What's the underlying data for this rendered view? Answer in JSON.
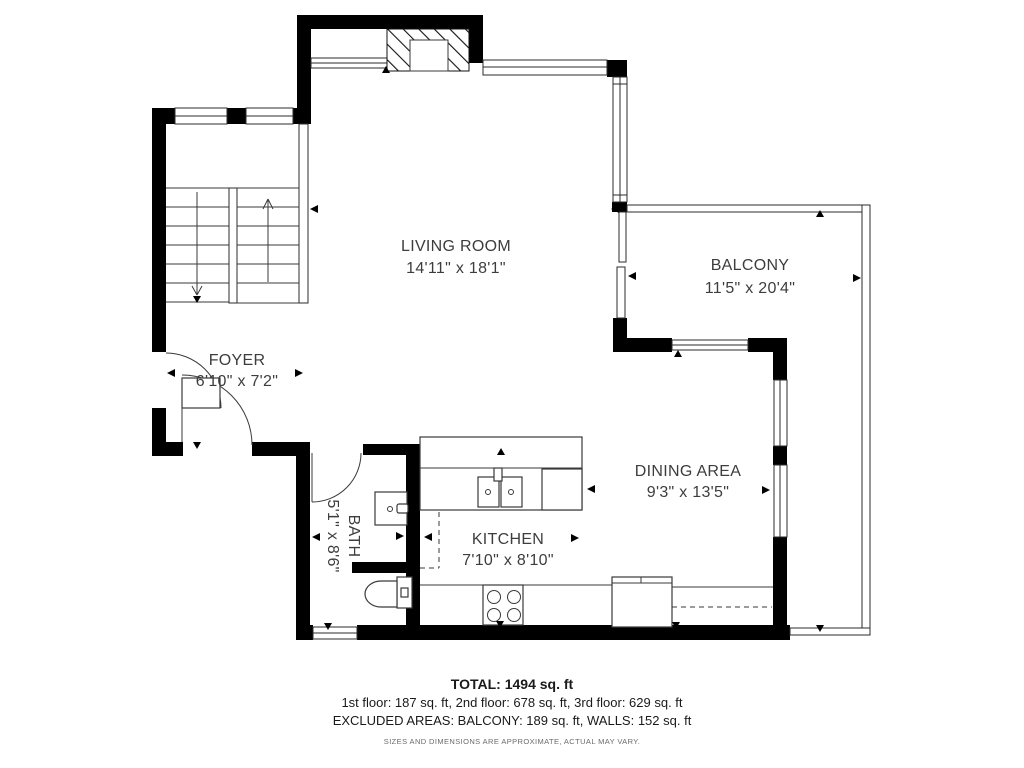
{
  "rooms": {
    "living": {
      "label": "LIVING ROOM",
      "dims": "14'11\" x 18'1\""
    },
    "balcony": {
      "label": "BALCONY",
      "dims": "11'5\" x 20'4\""
    },
    "foyer": {
      "label": "FOYER",
      "dims": "6'10\" x 7'2\""
    },
    "dining": {
      "label": "DINING AREA",
      "dims": "9'3\" x 13'5\""
    },
    "kitchen": {
      "label": "KITCHEN",
      "dims": "7'10\" x 8'10\""
    },
    "bath": {
      "label": "BATH",
      "dims": "5'1\" x 8'6\""
    }
  },
  "summary": {
    "total": "TOTAL: 1494 sq. ft",
    "floors": "1st floor: 187 sq. ft, 2nd floor: 678 sq. ft, 3rd floor: 629 sq. ft",
    "excluded": "EXCLUDED AREAS: BALCONY: 189 sq. ft, WALLS: 152 sq. ft",
    "disclaimer": "SIZES AND DIMENSIONS ARE APPROXIMATE, ACTUAL MAY VARY."
  },
  "colors": {
    "wall": "#000000",
    "line": "#3a3a3a",
    "text": "#3d3d3d"
  }
}
